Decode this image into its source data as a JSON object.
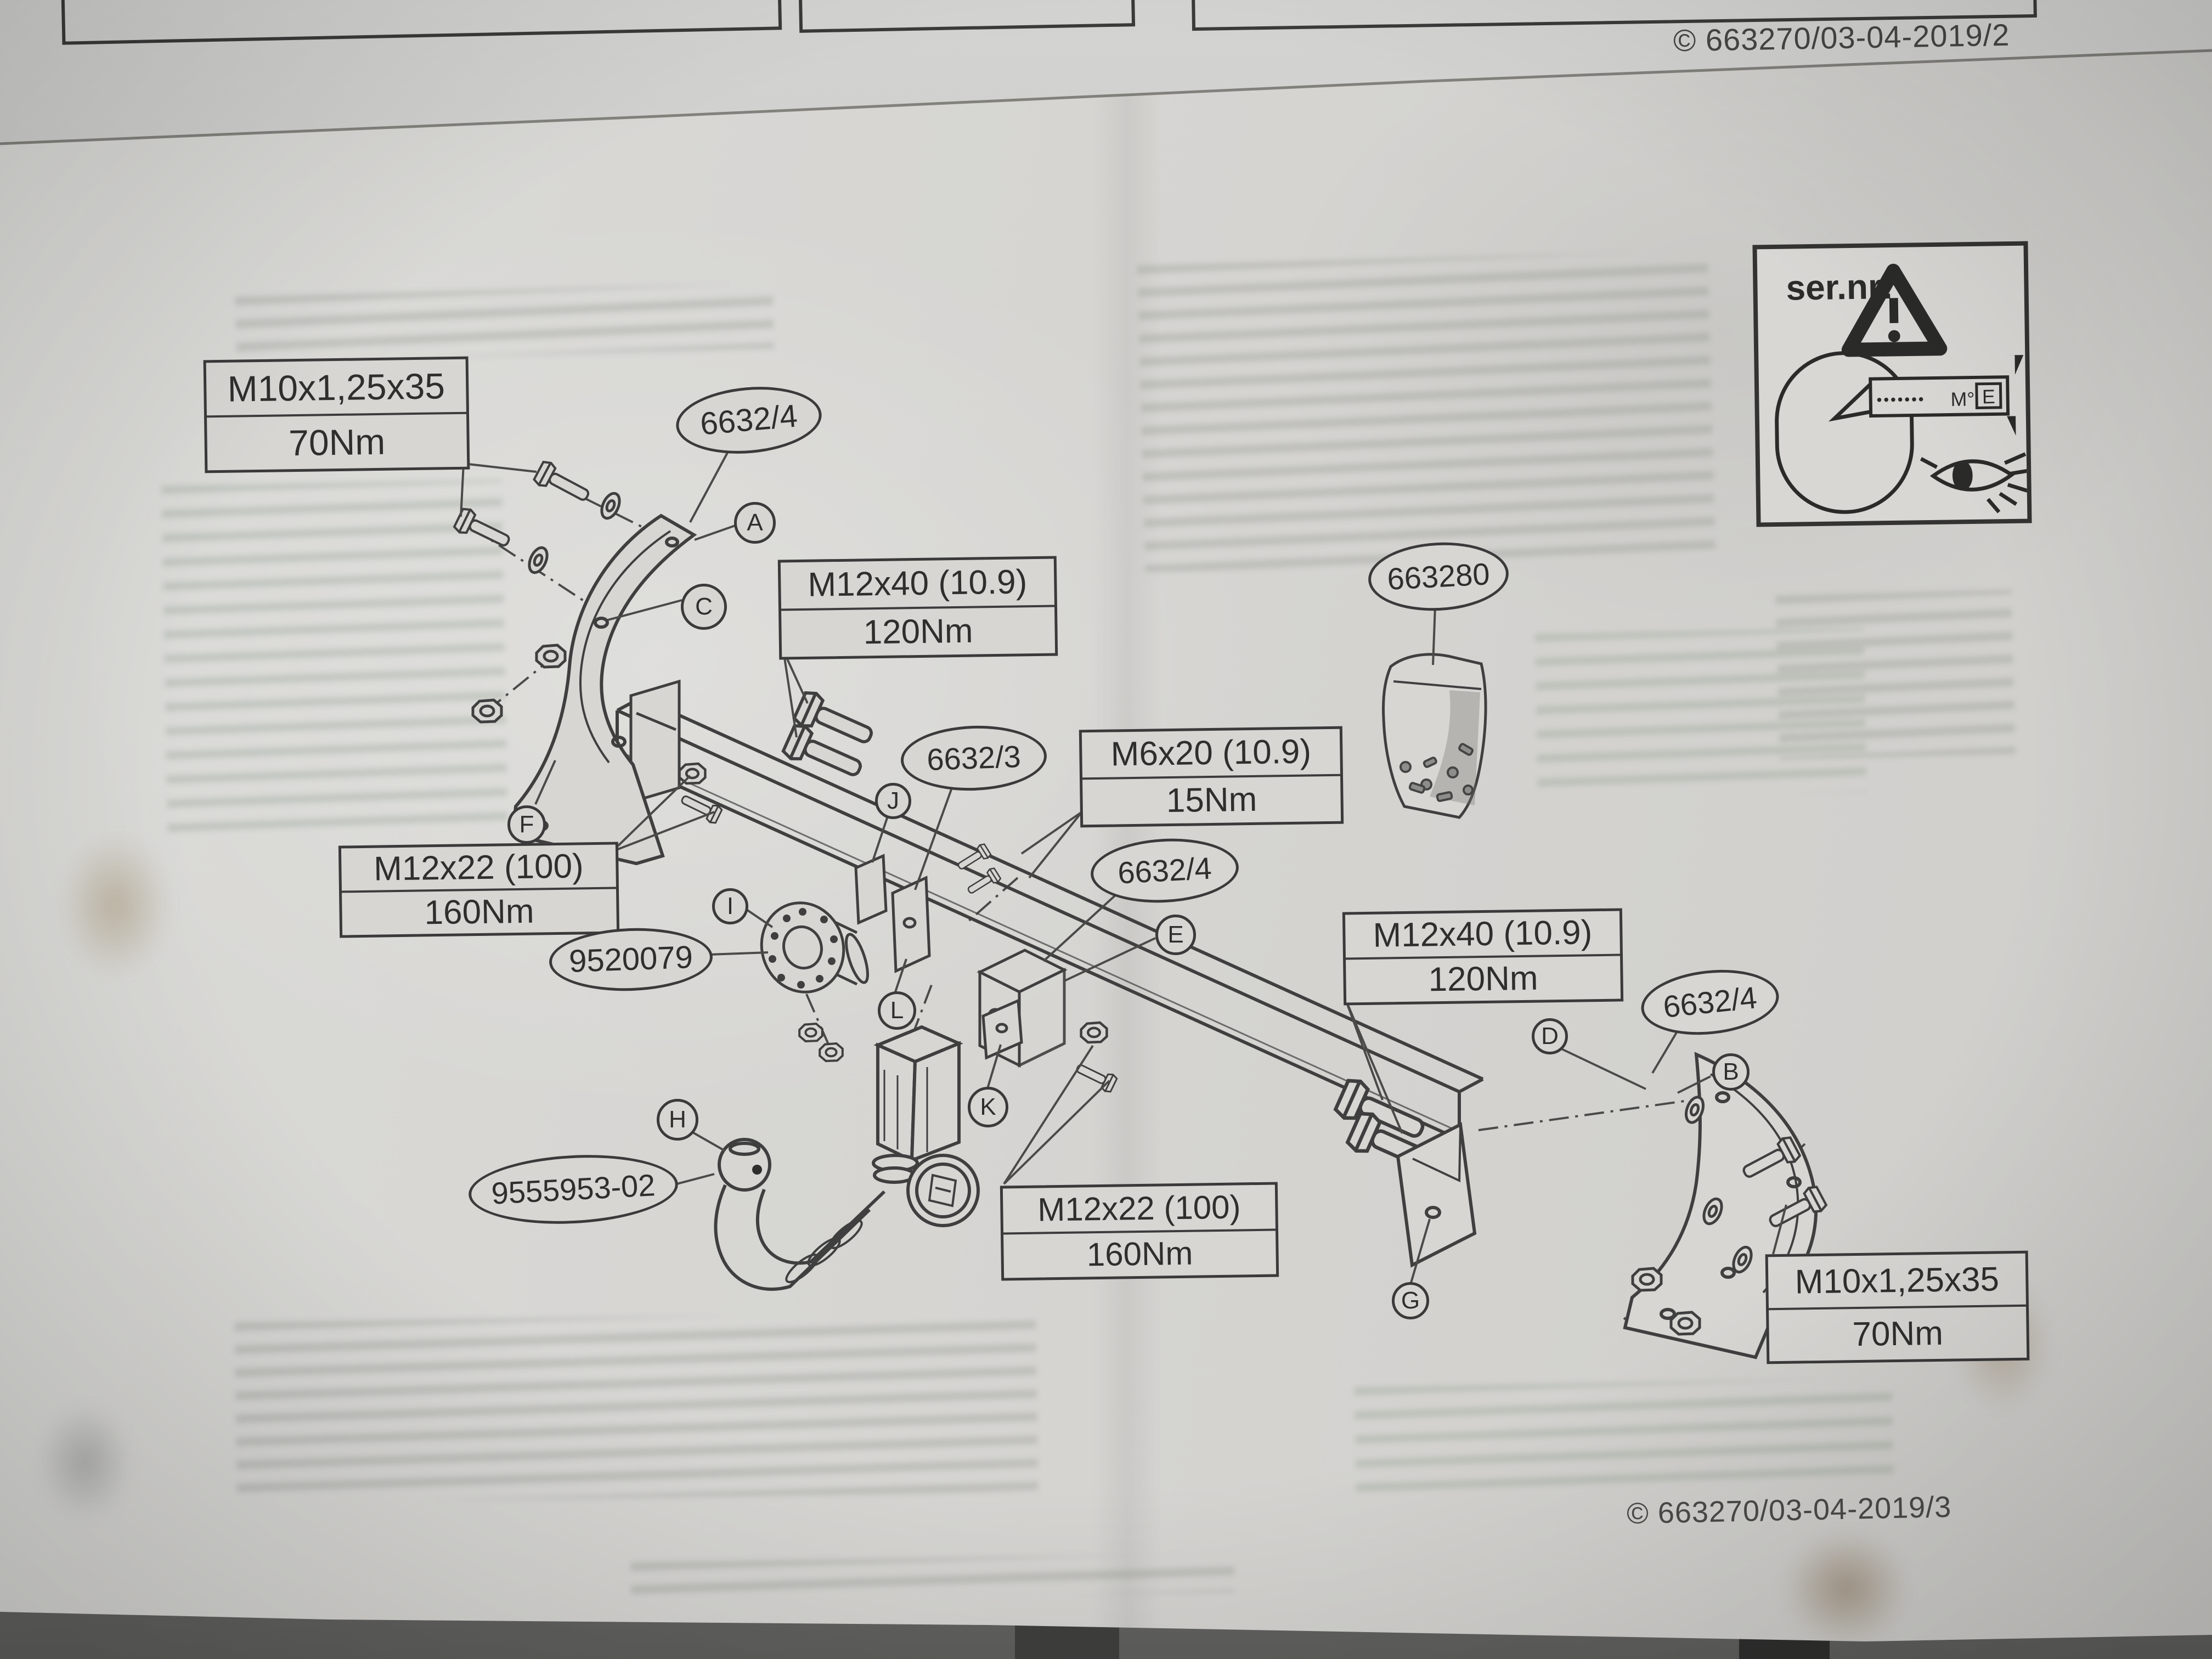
{
  "photo": {
    "prev_page_copyright": "© 663270/03-04-2019/2",
    "page_copyright": "© 663270/03-04-2019/3"
  },
  "sernr_panel": {
    "label": "ser.nr:",
    "tag_dots": "•••••••",
    "tag_code": "M°",
    "tag_mark": "E"
  },
  "torque_callouts": [
    {
      "spec": "M10x1,25x35",
      "torque": "70Nm"
    },
    {
      "spec": "M12x40 (10.9)",
      "torque": "120Nm"
    },
    {
      "spec": "M6x20 (10.9)",
      "torque": "15Nm"
    },
    {
      "spec": "M12x22 (100)",
      "torque": "160Nm"
    },
    {
      "spec": "M12x40 (10.9)",
      "torque": "120Nm"
    },
    {
      "spec": "M12x22 (100)",
      "torque": "160Nm"
    },
    {
      "spec": "M10x1,25x35",
      "torque": "70Nm"
    }
  ],
  "part_labels": [
    {
      "text": "6632/4"
    },
    {
      "text": "663280"
    },
    {
      "text": "6632/3"
    },
    {
      "text": "6632/4"
    },
    {
      "text": "6632/4"
    },
    {
      "text": "9520079"
    },
    {
      "text": "9555953-02"
    }
  ],
  "ref_markers": [
    "A",
    "C",
    "F",
    "J",
    "I",
    "L",
    "E",
    "K",
    "H",
    "D",
    "B",
    "G"
  ]
}
